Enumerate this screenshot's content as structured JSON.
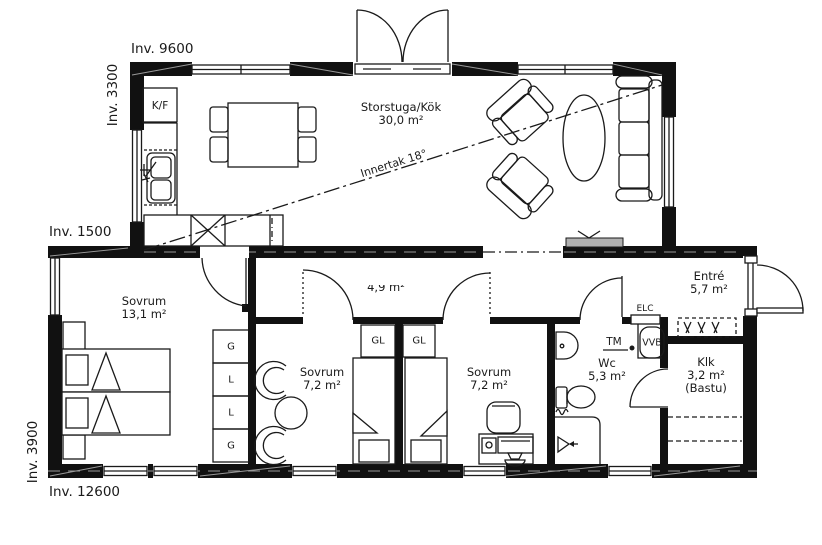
{
  "dimensions": {
    "top": "Inv. 9600",
    "left_upper": "Inv. 3300",
    "left_middle": "Inv. 1500",
    "left_lower": "Inv. 3900",
    "bottom": "Inv. 12600"
  },
  "rooms": {
    "storstuga": {
      "name": "Storstuga/Kök",
      "area": "30,0 m²"
    },
    "hall": {
      "area": "4,9 m²"
    },
    "sovrum_large": {
      "name": "Sovrum",
      "area": "13,1 m²"
    },
    "sovrum_mid": {
      "name": "Sovrum",
      "area": "7,2 m²"
    },
    "sovrum_right": {
      "name": "Sovrum",
      "area": "7,2 m²"
    },
    "wc": {
      "name": "Wc",
      "area": "5,3 m²"
    },
    "entre": {
      "name": "Entré",
      "area": "5,7 m²"
    },
    "klk": {
      "name": "Klk",
      "area": "3,2 m²",
      "note": "(Bastu)"
    }
  },
  "ceiling": {
    "label": "Innertak",
    "value": "18°"
  },
  "labels": {
    "fridge_freezer": "K/F",
    "electrical": "ELC",
    "washing_machine": "TM",
    "water_heater": "VVB",
    "closet_left": "GL",
    "closet_right": "GL",
    "wardrobes": [
      "G",
      "L",
      "L",
      "G"
    ]
  },
  "colors": {
    "wall": "#111111",
    "line": "#1a1a1a",
    "text": "#1a1a1a",
    "bench_gray": "#b0b0b0"
  }
}
